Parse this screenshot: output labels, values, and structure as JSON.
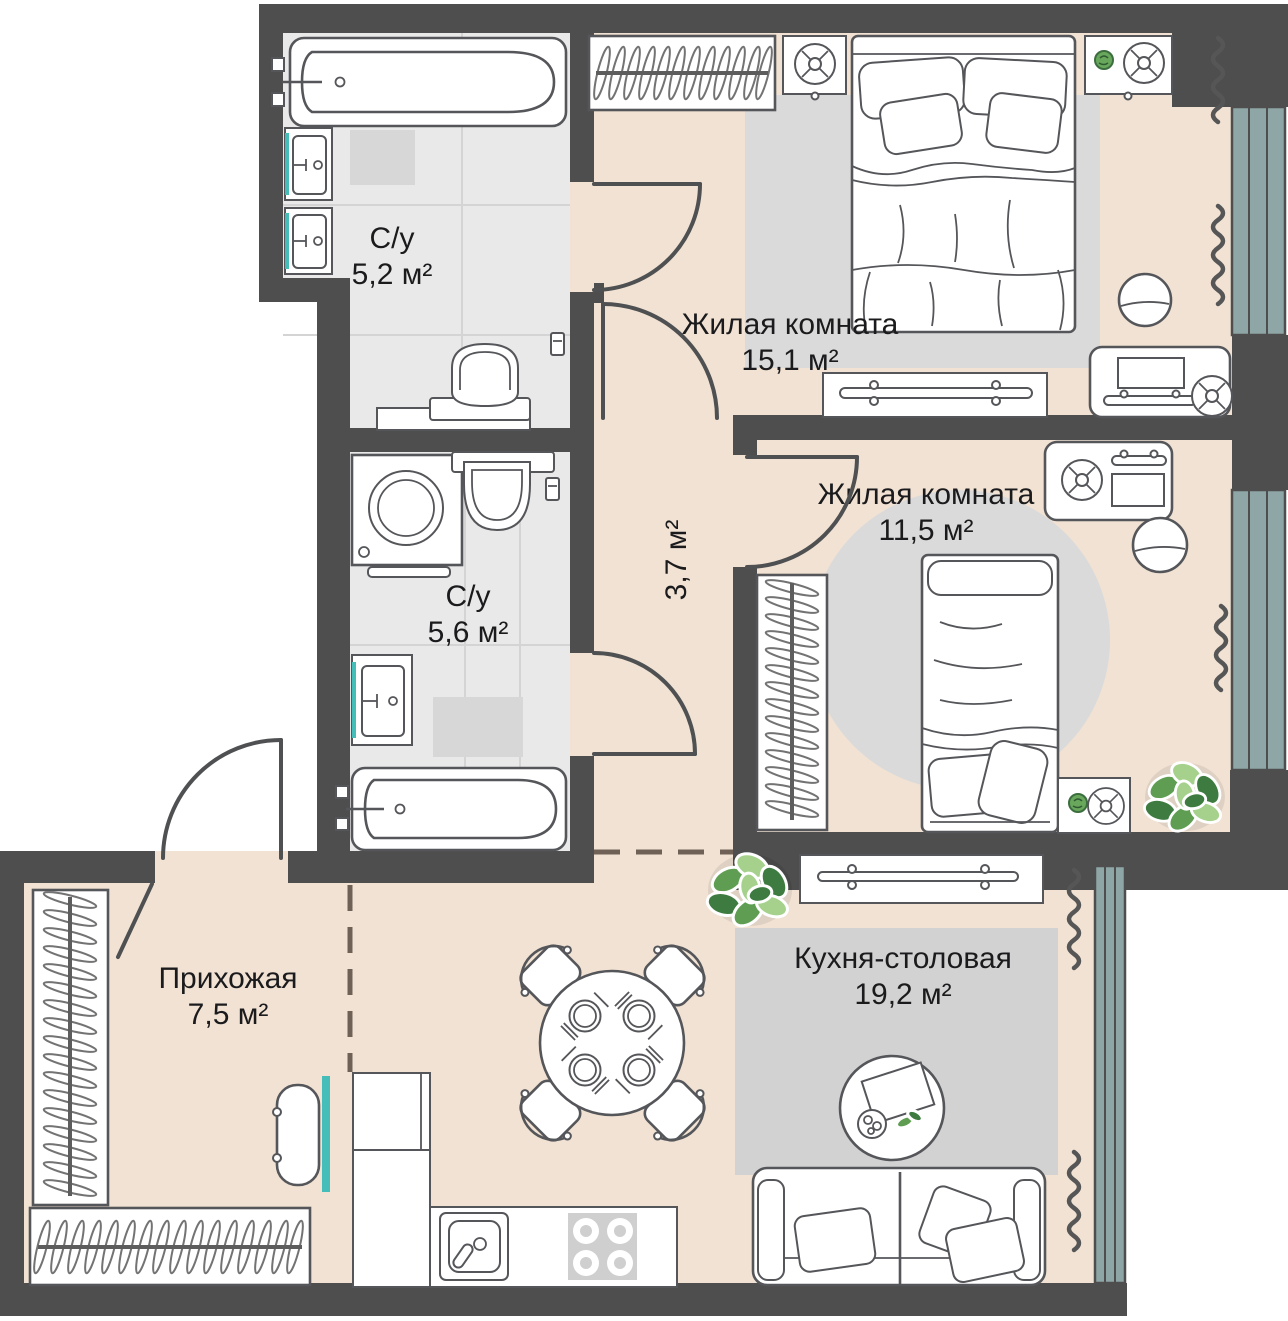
{
  "meta": {
    "type": "apartment-floor-plan",
    "units": "м²"
  },
  "colors": {
    "wall": "#4e4e4e",
    "floor_beige": "#f1e2d3",
    "bathroom_tile": "#e9e9e9",
    "window_glass": "#8ea7a6",
    "accent_teal": "#45bdb8",
    "rug_gray": "#d7d7d7",
    "plant_green": "#5f9e52",
    "label_text": "#1b1b1d"
  },
  "rooms": [
    {
      "id": "bathroom-1",
      "name": "С/у",
      "area": "5,2 м²"
    },
    {
      "id": "bathroom-2",
      "name": "С/у",
      "area": "5,6 м²"
    },
    {
      "id": "hallway",
      "name": "",
      "area": "3,7 м²"
    },
    {
      "id": "bedroom-1",
      "name": "Жилая комната",
      "area": "15,1 м²"
    },
    {
      "id": "bedroom-2",
      "name": "Жилая комната",
      "area": "11,5 м²"
    },
    {
      "id": "entry",
      "name": "Прихожая",
      "area": "7,5 м²"
    },
    {
      "id": "kitchen",
      "name": "Кухня-столовая",
      "area": "19,2 м²"
    }
  ]
}
